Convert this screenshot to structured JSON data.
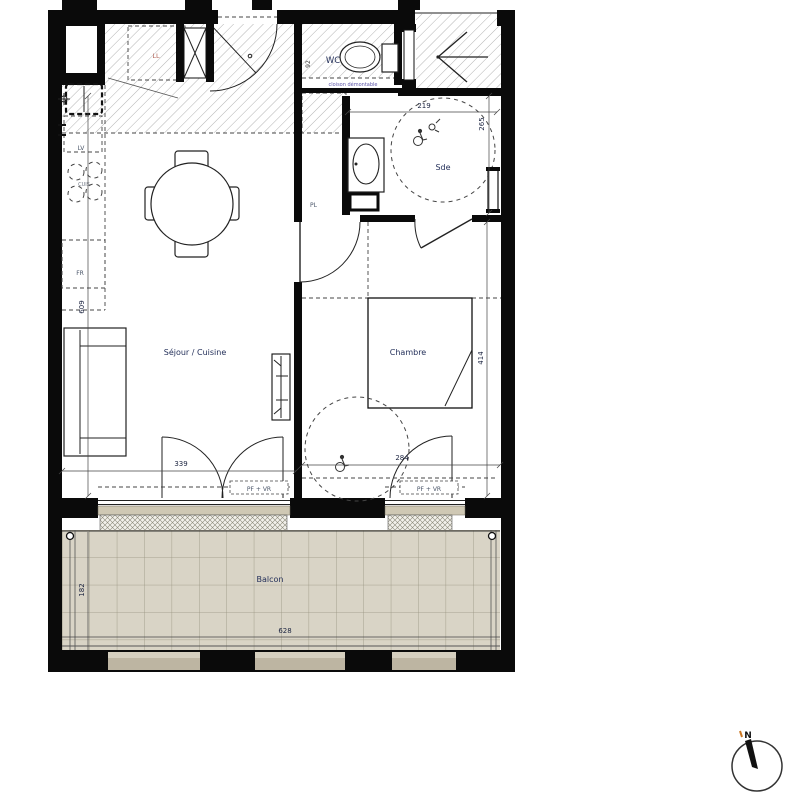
{
  "plan": {
    "rooms": {
      "sejour": "Séjour / Cuisine",
      "chambre": "Chambre",
      "sde": "Sde",
      "wc": "WC",
      "balcon": "Balcon",
      "pl": "PL"
    },
    "appliances": {
      "ll": "LL",
      "lv": "LV",
      "cuis": "CUIS",
      "fr": "FR"
    },
    "notes": {
      "cloison": "cloison démontable",
      "pf_vr_sejour": "PF + VR",
      "pf_vr_chambre": "PF + VR"
    },
    "dimensions": {
      "sde_width": "219",
      "sde_height": "265",
      "sejour_depth": "609",
      "chambre_depth": "414",
      "sejour_width": "339",
      "chambre_width": "284",
      "balcon_depth": "182",
      "balcon_width": "628",
      "door_width": "92"
    },
    "compass": {
      "north": "N"
    },
    "colors": {
      "wall": "#0a0a0a",
      "label": "#24305a",
      "balcony_tile": "#d9d4c6",
      "balcony_grid": "#97927f",
      "sill": "#cfc8b4",
      "railing": "#bfb7a4",
      "ll_label": "#b2655a",
      "note": "#5c55a8"
    }
  }
}
